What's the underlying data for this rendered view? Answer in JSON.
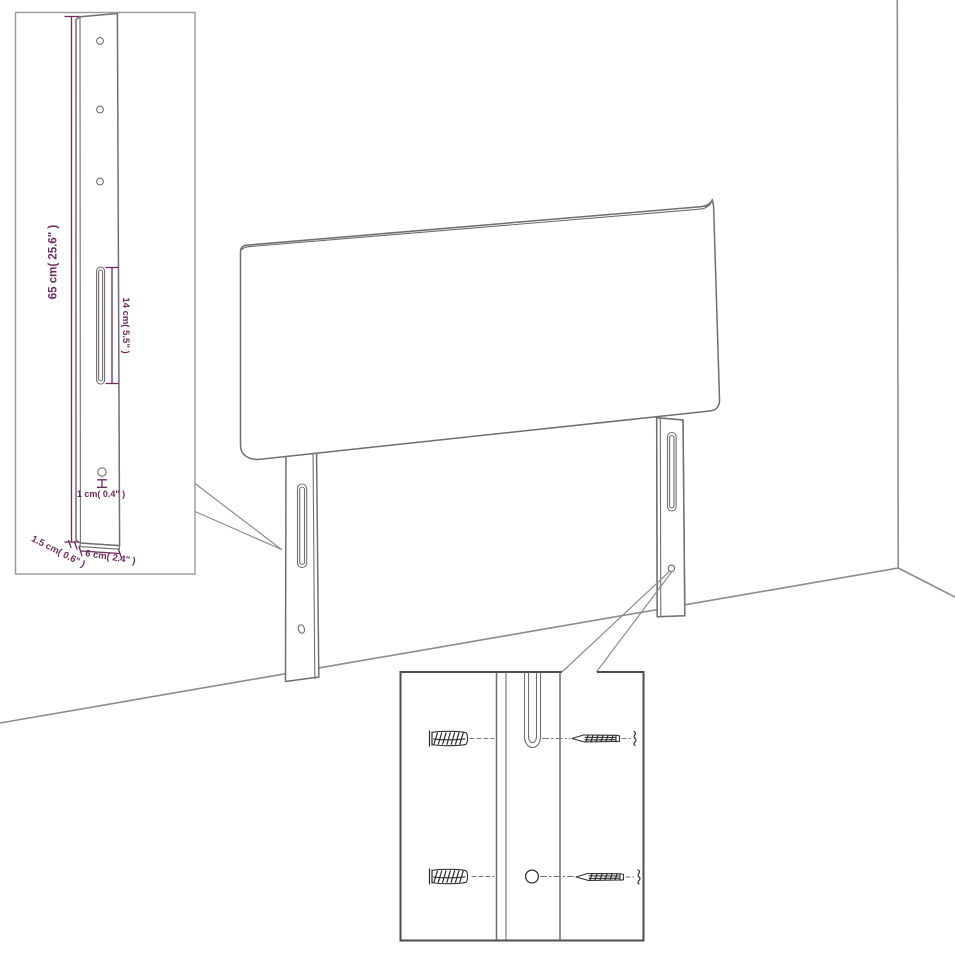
{
  "colors": {
    "dimension_text": "#6e2b5f",
    "drawing_line": "#6f6f6f",
    "room_line": "#8c8c8c",
    "inset_border_light": "#9a9a9a",
    "inset_border_dark": "#4d4d4d"
  },
  "bracket_inset": {
    "labels": {
      "height": "65 cm( 25.6\" )",
      "slot_height": "14 cm( 5.5\" )",
      "hole_diameter": "1 cm( 0.4\" )",
      "thickness": "1.5 cm( 0.6\" )",
      "width": "6 cm( 2.4\" )"
    }
  }
}
